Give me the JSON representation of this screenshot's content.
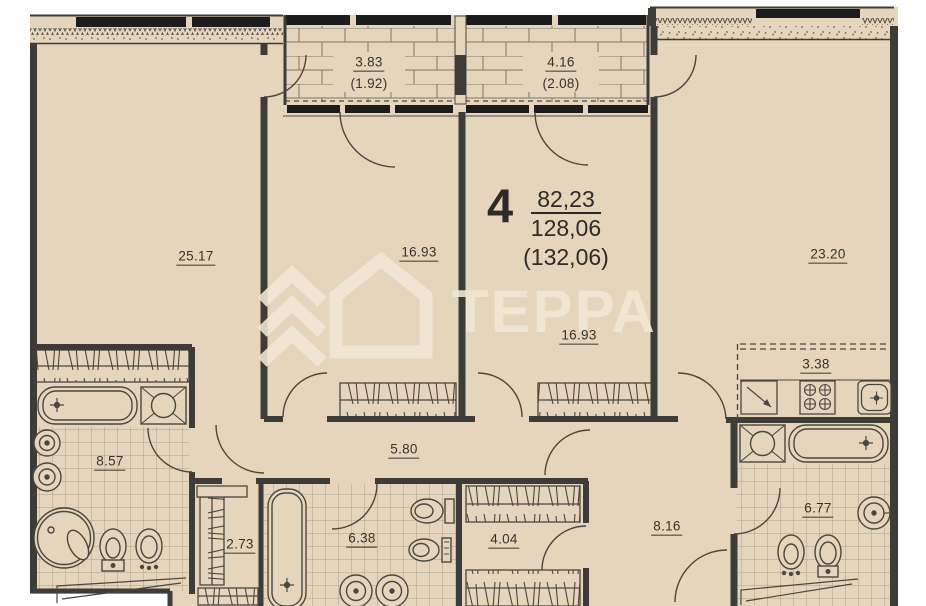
{
  "watermark": {
    "brand": "ТЕРРА"
  },
  "apartment": {
    "number": "4",
    "living_area": "82,23",
    "total_area": "128,06",
    "total_area_with_balcony": "(132,06)"
  },
  "balconies": [
    {
      "id": "balcony-left",
      "area": "3.83",
      "reduced_area": "(1.92)"
    },
    {
      "id": "balcony-right",
      "area": "4.16",
      "reduced_area": "(2.08)"
    }
  ],
  "rooms": [
    {
      "id": "living-room-left",
      "area": "25.17"
    },
    {
      "id": "bedroom-middle-left",
      "area": "16.93"
    },
    {
      "id": "bedroom-middle-right",
      "area": "16.93"
    },
    {
      "id": "living-room-right",
      "area": "23.20"
    },
    {
      "id": "bathroom-left",
      "area": "8.57"
    },
    {
      "id": "corridor",
      "area": "5.80"
    },
    {
      "id": "closet",
      "area": "2.73"
    },
    {
      "id": "bathroom-middle",
      "area": "6.38"
    },
    {
      "id": "wardrobe",
      "area": "4.04"
    },
    {
      "id": "hall",
      "area": "8.16"
    },
    {
      "id": "kitchen-niche",
      "area": "3.38"
    },
    {
      "id": "bathroom-right",
      "area": "6.77"
    }
  ],
  "colors": {
    "floor": "#e4d5bc",
    "wall": "#3e3c37",
    "window": "#1c1c1c",
    "watermark": "#f1e8d6"
  }
}
